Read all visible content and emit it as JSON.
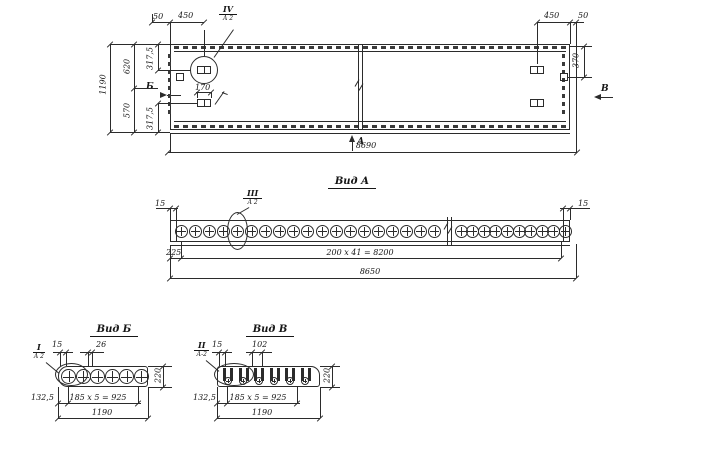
{
  "colors": {
    "ink": "#2b2b2b",
    "paper": "#ffffff"
  },
  "top_view": {
    "callout": {
      "num": "IV",
      "sheet": "А 2"
    },
    "arrows": {
      "a": "А",
      "b": "Б",
      "v": "В"
    },
    "dims": {
      "left_offset": "50",
      "left_anchor": "450",
      "right_anchor": "450",
      "right_offset": "50",
      "right_370": "370",
      "height_total": "1190",
      "height_620": "620",
      "height_570": "570",
      "height_3175_top": "317,5",
      "height_3175_bot": "317,5",
      "length_total": "8690",
      "anchor_170": "170"
    }
  },
  "view_a": {
    "title": "Вид А",
    "callout": {
      "num": "III",
      "sheet": "А 2"
    },
    "dims": {
      "rim_left": "15",
      "rim_right": "15",
      "start": "225",
      "spacing": "200 х 41 = 8200",
      "total": "8650"
    }
  },
  "view_b": {
    "title": "Вид Б",
    "callout": {
      "num": "I",
      "sheet": "А 2"
    },
    "dims": {
      "rim": "15",
      "web": "26",
      "thickness": "220",
      "edge": "132,5",
      "spacing": "185 х 5 = 925",
      "total": "1190"
    }
  },
  "view_v": {
    "title": "Вид В",
    "callout": {
      "num": "II",
      "sheet": "А-2"
    },
    "dims": {
      "rim": "15",
      "slot": "102",
      "thickness": "220",
      "edge": "132,5",
      "spacing": "185 х 5 = 925",
      "total": "1190"
    }
  },
  "geometry": {
    "view_a_holes_left": 19,
    "view_a_holes_right": 10,
    "view_b_holes": 6,
    "view_v_slots": 6
  }
}
